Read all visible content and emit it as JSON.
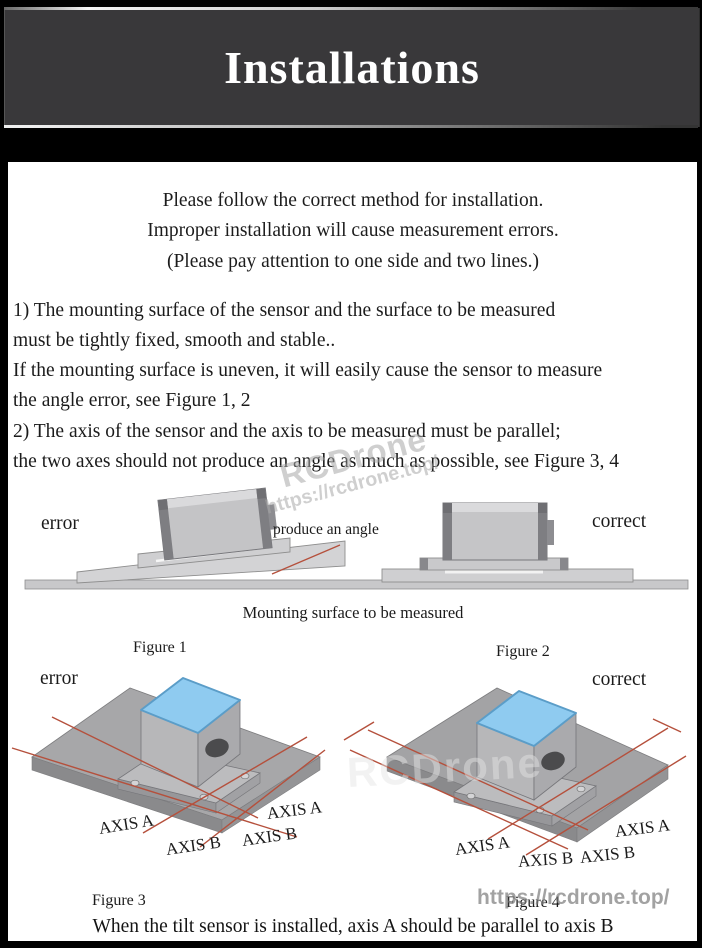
{
  "header": {
    "title": "Installations"
  },
  "intro": {
    "line1": "Please follow the correct method for installation.",
    "line2": "Improper installation will cause measurement errors.",
    "line3": "(Please pay attention to one side and two lines.)"
  },
  "instructions": {
    "line1": "1) The mounting surface of the sensor and the surface to be measured",
    "line2": "must be tightly fixed, smooth and stable..",
    "line3": "If the mounting surface is uneven, it will easily cause the sensor to measure",
    "line4": "the angle error, see Figure 1, 2",
    "line5": "2) The axis of the sensor and the axis to be measured must be parallel;",
    "line6": "the two axes should not produce an angle as much as possible, see Figure 3, 4"
  },
  "figures": {
    "fig1": {
      "status": "error",
      "annotation": "produce an angle",
      "caption": "Figure 1"
    },
    "fig2": {
      "status": "correct",
      "caption": "Figure 2"
    },
    "surface_caption": "Mounting surface to be measured",
    "fig3": {
      "status": "error",
      "caption": "Figure 3",
      "axis_a": "AXIS A",
      "axis_b": "AXIS B"
    },
    "fig4": {
      "status": "correct",
      "caption": "Figure 4",
      "axis_a": "AXIS A",
      "axis_b": "AXIS B"
    }
  },
  "footer": {
    "note": "When the tilt sensor is installed, axis A should be parallel to axis B"
  },
  "watermark": {
    "brand": "RCDrone",
    "url": "https://rcdrone.top/"
  },
  "colors": {
    "header_bg": "#39383a",
    "accent_red": "#b5503c",
    "sensor_top_blue": "#8fcbf0",
    "plate_gray": "#a7a7a9"
  }
}
